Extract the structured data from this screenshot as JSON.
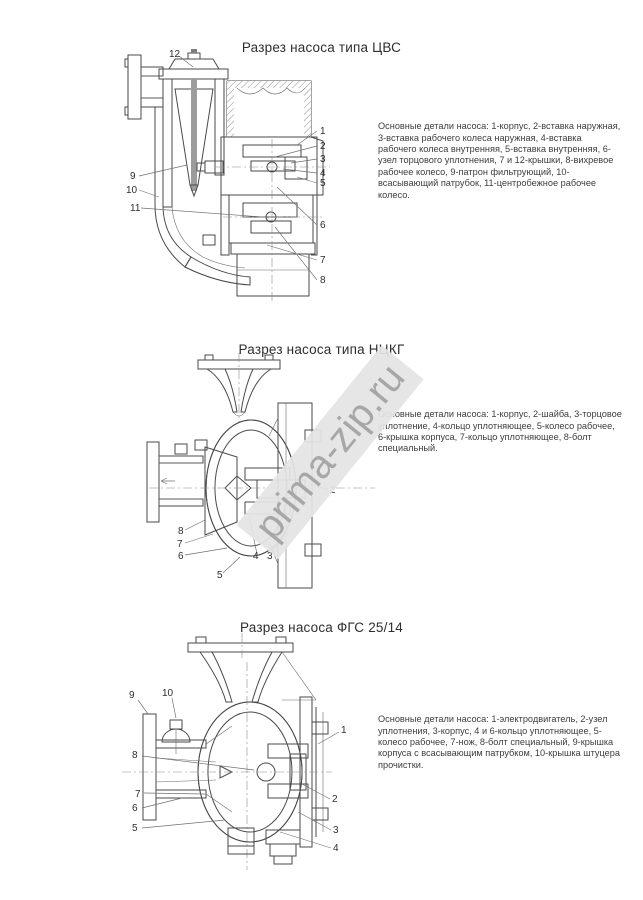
{
  "watermark": {
    "text": "prima-zip.ru",
    "text_color": "#a7a7a7",
    "band_color": "#e4e4e4"
  },
  "page": {
    "background": "#ffffff",
    "ink_color": "#4a4a4a"
  },
  "sections": [
    {
      "title": "Разрез насоса типа ЦВС",
      "description": "Основные детали насоса: 1-корпус, 2-вставка наружная, 3-вставка рабочего колеса наружная, 4-вставка рабочего колеса внутренняя, 5-вставка внутренняя, 6-узел торцового уплотнения, 7 и 12-крышки, 8-вихревое рабочее колесо, 9-патрон фильтрующий, 10-всасывающий патрубок, 11-центробежное рабочее колесо.",
      "callouts": [
        "1",
        "2",
        "3",
        "4",
        "5",
        "6",
        "7",
        "8",
        "9",
        "10",
        "11",
        "12"
      ]
    },
    {
      "title": "Разрез насоса типа НЦКГ",
      "description": "Основные детали насоса: 1-корпус, 2-шайба, 3-торцовое уплотнение, 4-кольцо уплотняющее, 5-колесо рабочее, 6-крышка корпуса, 7-кольцо уплотняющее, 8-болт специальный.",
      "callouts": [
        "2",
        "3",
        "4",
        "5",
        "6",
        "7",
        "8"
      ]
    },
    {
      "title": "Разрез насоса ФГС 25/14",
      "description": "Основные детали насоса: 1-электродвигатель, 2-узел уплотнения, 3-корпус, 4 и 6-кольцо уплотняющее, 5-колесо рабочее, 7-нож, 8-болт специальный, 9-крышка корпуса с всасывающим патрубком, 10-крышка штуцера прочистки.",
      "callouts": [
        "1",
        "2",
        "3",
        "4",
        "5",
        "6",
        "7",
        "8",
        "9",
        "10"
      ]
    }
  ]
}
